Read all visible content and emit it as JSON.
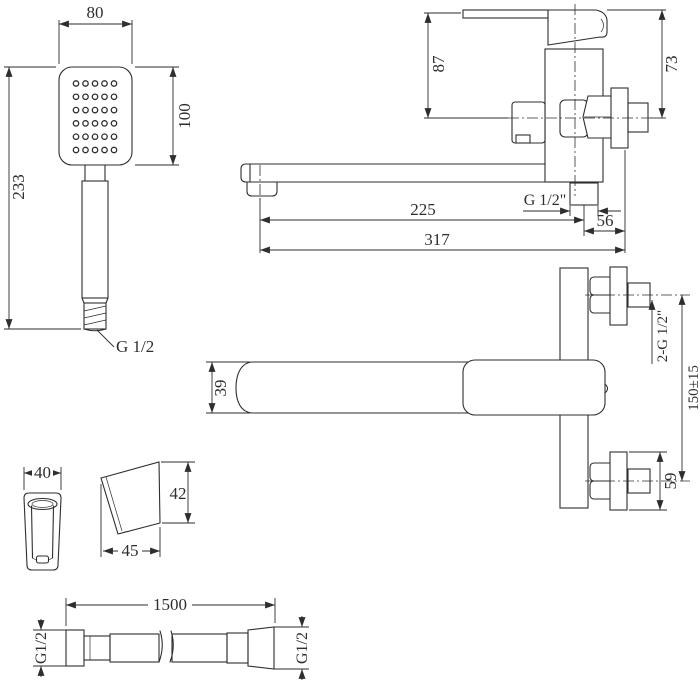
{
  "colors": {
    "line": "#2e2e2e",
    "background": "#ffffff"
  },
  "hand_shower": {
    "dim_width": "80",
    "dim_head_height": "100",
    "dim_length": "233",
    "thread_label": "G 1/2",
    "nozzle_grid": {
      "rows": 6,
      "cols": 5
    }
  },
  "faucet_side_view": {
    "dim_top_to_axis": "87",
    "dim_right_top_to_axis": "73",
    "outlet_thread_label": "G 1/2\"",
    "dim_axis_to_spout": "225",
    "dim_outlet_to_wall": "56",
    "dim_overall": "317"
  },
  "faucet_top_view": {
    "dim_spout_width": "39",
    "thread_label": "2-G 1/2\"",
    "dim_connection_centers": "150±15",
    "dim_flange": "59"
  },
  "bracket": {
    "dim_width": "40",
    "dim_height": "42",
    "dim_depth": "45"
  },
  "hose": {
    "dim_length": "1500",
    "thread_label_left": "G1/2",
    "thread_label_right": "G1/2"
  }
}
